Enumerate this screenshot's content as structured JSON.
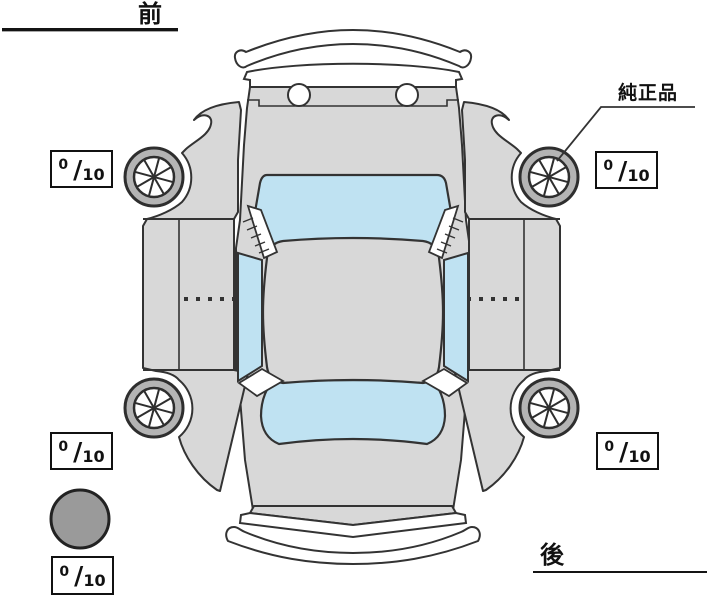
{
  "diagram": {
    "title": "vehicle inspection top view",
    "front_label": "前",
    "rear_label": "後",
    "genuine_part_label": "純正品",
    "fraction_separator": "/",
    "meters": {
      "front_left": {
        "value": "0",
        "max": "10"
      },
      "front_right": {
        "value": "0",
        "max": "10"
      },
      "rear_left": {
        "value": "0",
        "max": "10"
      },
      "rear_right": {
        "value": "0",
        "max": "10"
      },
      "spare": {
        "value": "0",
        "max": "10"
      }
    },
    "colors": {
      "body": "#d8d8d8",
      "glass": "#bfe2f2",
      "wheel_ring": "#b4b4b4",
      "wheel_hub": "#ffffff",
      "spare_tire": "#9a9a9a",
      "outline": "#333333",
      "background": "#ffffff"
    }
  }
}
